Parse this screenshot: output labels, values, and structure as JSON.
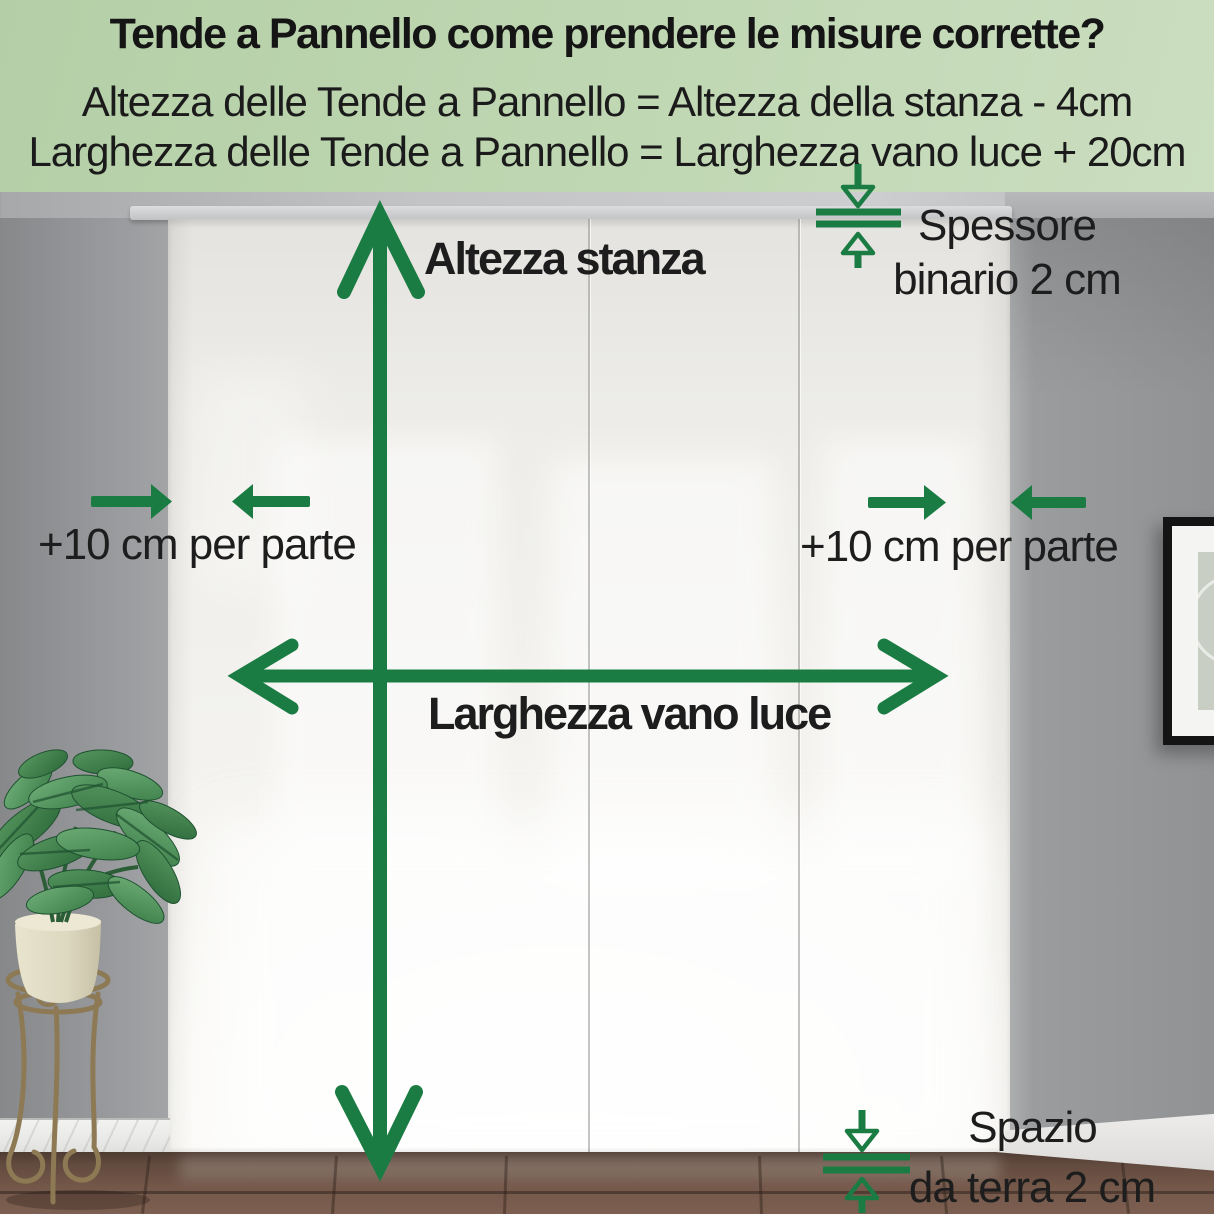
{
  "header": {
    "title": "Tende a Pannello come prendere le misure corrette?",
    "formula_height": "Altezza delle Tende a Pannello = Altezza della stanza - 4cm",
    "formula_width": "Larghezza delle Tende a Pannello = Larghezza vano luce + 20cm"
  },
  "measurements": {
    "room_height": "Altezza stanza",
    "opening_width": "Larghezza vano luce",
    "side_margin_left": "+10 cm per parte",
    "side_margin_right": "+10 cm per parte",
    "track_thickness_line1": "Spessore",
    "track_thickness_line2": "binario 2 cm",
    "floor_gap_line1": "Spazio",
    "floor_gap_line2": "da terra 2 cm"
  },
  "colors": {
    "header_background": "#bcd4ae",
    "arrow_green": "#1b7c43",
    "text_black": "#1c1c1c",
    "wall_gray": "#96989a",
    "curtain_ivory": "#f2f1ed",
    "floor_brown": "#6c5245"
  },
  "scene": {
    "curtain_panel_count": 3
  }
}
